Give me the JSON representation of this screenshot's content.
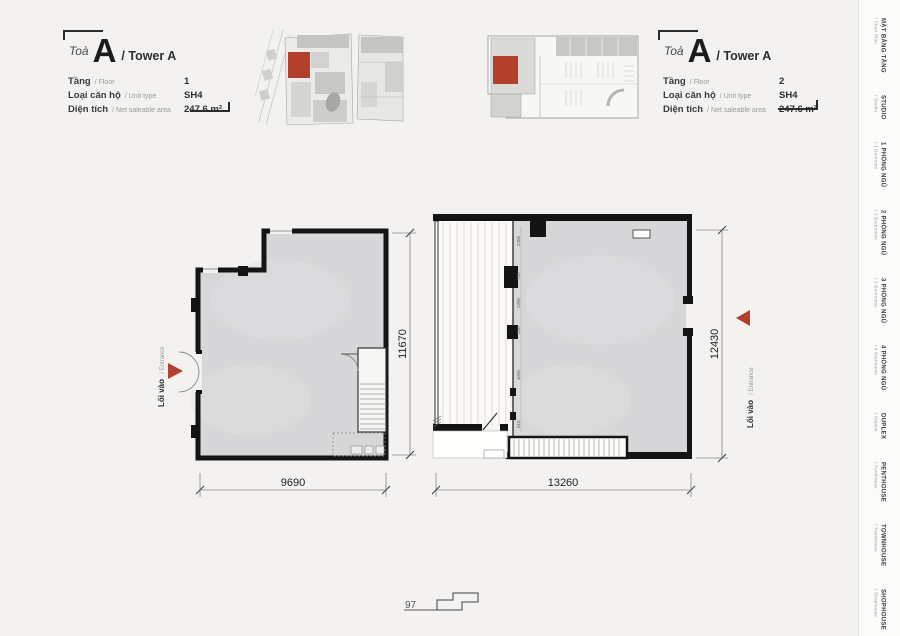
{
  "colors": {
    "accent_red": "#b2402c",
    "wall_black": "#141414",
    "plan_fill": "#d7d7d9",
    "active_tab_brown": "#8c7c6b"
  },
  "info_left": {
    "toa": "Toà",
    "letter": "A",
    "tower": "/  Tower A",
    "rows": [
      {
        "label": "Tầng",
        "sub": "/ Floor",
        "value": "1"
      },
      {
        "label": "Loại căn hộ",
        "sub": "/ Unit type",
        "value": "SH4"
      },
      {
        "label": "Diện tích",
        "sub": "/ Net saleable area",
        "value": "247.6 m²"
      }
    ]
  },
  "info_right": {
    "toa": "Toà",
    "letter": "A",
    "tower": "/  Tower A",
    "rows": [
      {
        "label": "Tầng",
        "sub": "/ Floor",
        "value": "2"
      },
      {
        "label": "Loại căn hộ",
        "sub": "/ Unit type",
        "value": "SH4"
      },
      {
        "label": "Diện tích",
        "sub": "/ Net saleable area",
        "value": "247.6 m²"
      }
    ]
  },
  "plan_left": {
    "bottom_dim": "9690",
    "side_dim": "11670",
    "entrance": {
      "vn": "Lối vào",
      "en": "/ Entrance"
    }
  },
  "plan_right": {
    "bottom_dim": "13260",
    "side_dim": "12430",
    "entrance": {
      "vn": "Lối vào",
      "en": "/ Entrance"
    },
    "interior_dims": [
      "2300",
      "700",
      "2300",
      "200",
      "4000",
      "810"
    ]
  },
  "sidebar": {
    "active": "SHOPHOUSE",
    "items": [
      {
        "vn": "MẶT BẰNG TẦNG",
        "en": "/ Floor Plan"
      },
      {
        "vn": "STUDIO",
        "en": "/ Studio"
      },
      {
        "vn": "1 PHÒNG NGỦ",
        "en": "/ 1 Bedroom"
      },
      {
        "vn": "2 PHÒNG NGỦ",
        "en": "/ 2 Bedrooms"
      },
      {
        "vn": "3 PHÒNG NGỦ",
        "en": "/ 3 Bedrooms"
      },
      {
        "vn": "4 PHÒNG NGỦ",
        "en": "/ 4 Bedrooms"
      },
      {
        "vn": "DUPLEX",
        "en": "/ Duplex"
      },
      {
        "vn": "PENTHOUSE",
        "en": "/ Penthouse"
      },
      {
        "vn": "TOWNHOUSE",
        "en": "/ Townhouse"
      },
      {
        "vn": "SHOPHOUSE",
        "en": "/ Shophouse"
      }
    ]
  },
  "footer": {
    "page_number": "97"
  }
}
